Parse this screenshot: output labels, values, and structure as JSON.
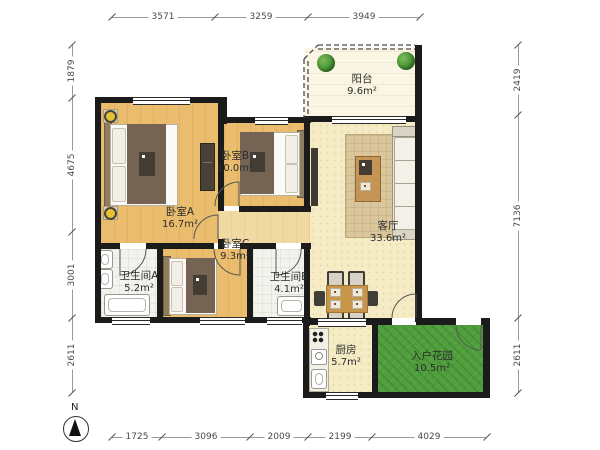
{
  "title": "apartment-floor-plan",
  "rooms": [
    {
      "name": "阳台",
      "area": "9.6m²"
    },
    {
      "name": "卧室B",
      "area": "10.0m²"
    },
    {
      "name": "卧室A",
      "area": "16.7m²"
    },
    {
      "name": "卧室C",
      "area": "9.3m²"
    },
    {
      "name": "卫生间A",
      "area": "5.2m²"
    },
    {
      "name": "卫生间B",
      "area": "4.1m²"
    },
    {
      "name": "客厅",
      "area": "33.6m²"
    },
    {
      "name": "厨房",
      "area": "5.7m²"
    },
    {
      "name": "入户花园",
      "area": "10.5m²"
    }
  ],
  "dimensions": {
    "top": [
      "3571",
      "3259",
      "3949"
    ],
    "bottom": [
      "1725",
      "3096",
      "2009",
      "2199",
      "4029"
    ],
    "left": [
      "1879",
      "4675",
      "3001",
      "2611"
    ],
    "right": [
      "2419",
      "7136",
      "2611"
    ]
  },
  "compass": {
    "label": "N"
  },
  "colors": {
    "wall": "#1b1b1b",
    "wood_floor": "#eabd6e",
    "living_floor": "#f5ecc6",
    "bath_floor": "#f3f3ee",
    "balcony_floor": "#faf6e3",
    "garden": "#4f9f3c",
    "rug": "#dbc69c"
  }
}
